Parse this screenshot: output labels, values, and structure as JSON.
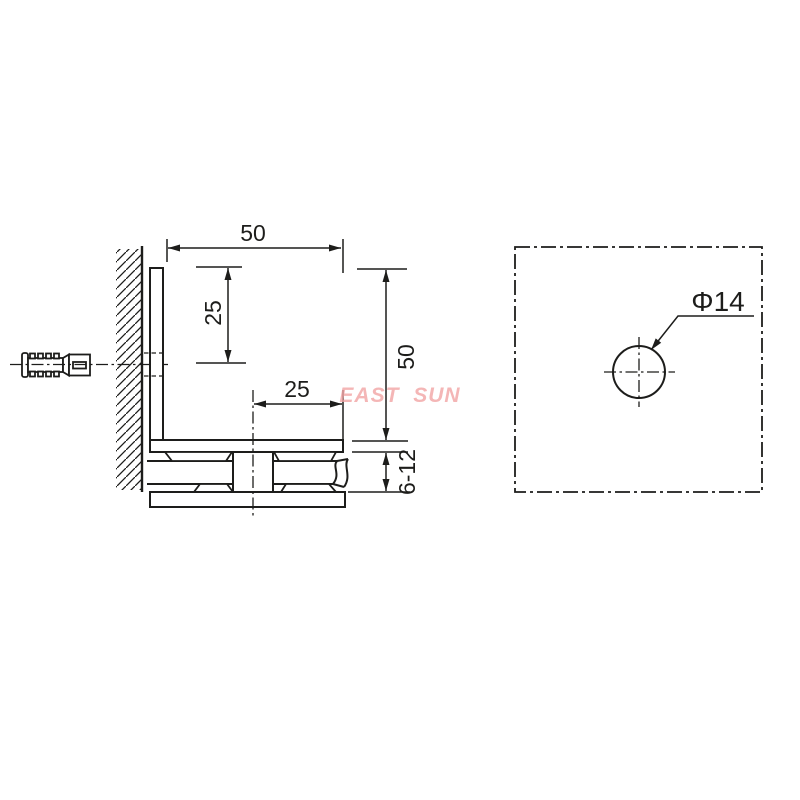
{
  "colors": {
    "line": "#1d1d1b",
    "background": "#ffffff",
    "watermark": "#f2a4a4"
  },
  "watermark": {
    "text": "EAST SUN",
    "color": "#f2a4a4"
  },
  "side_view": {
    "dim_arm_length": "50",
    "dim_hole_center_from_top": "25",
    "dim_screw_center_from_edge": "25",
    "dim_overall_height": "50",
    "dim_glass_thickness": "6-12"
  },
  "face_view": {
    "dim_hole_diameter": "Φ14"
  }
}
